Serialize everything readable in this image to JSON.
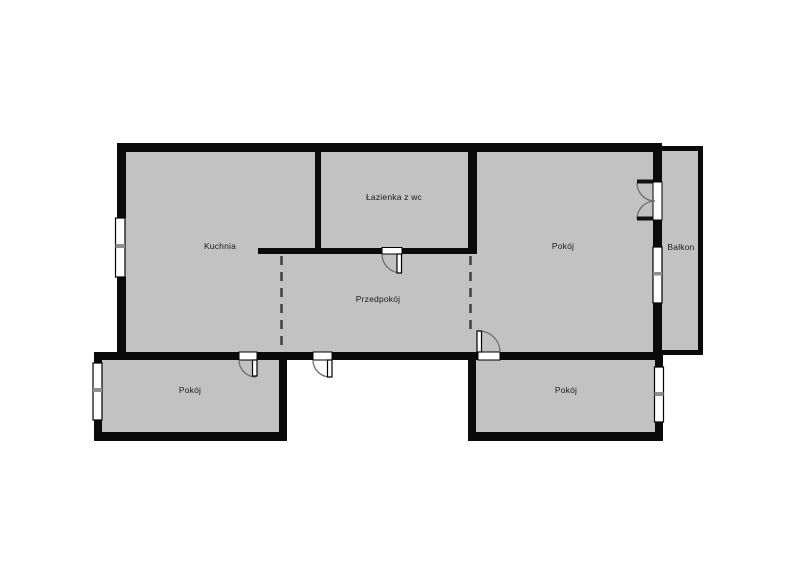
{
  "floorplan": {
    "rooms": {
      "kitchen": {
        "label": "Kuchnia"
      },
      "bathroom": {
        "label": "Łazienka z wc"
      },
      "hallway": {
        "label": "Przedpokój"
      },
      "room_top_right": {
        "label": "Pokój"
      },
      "room_bottom_left": {
        "label": "Pokój"
      },
      "room_bottom_right": {
        "label": "Pokój"
      },
      "balcony": {
        "label": "Balkon"
      }
    },
    "colors": {
      "wall": "#0a0a0a",
      "floor": "#c2c2c2",
      "background": "#ffffff",
      "window_divider": "#8f8f8f",
      "door_arc": "#6e6e6e",
      "passage_dash": "#3f3f3f"
    }
  }
}
